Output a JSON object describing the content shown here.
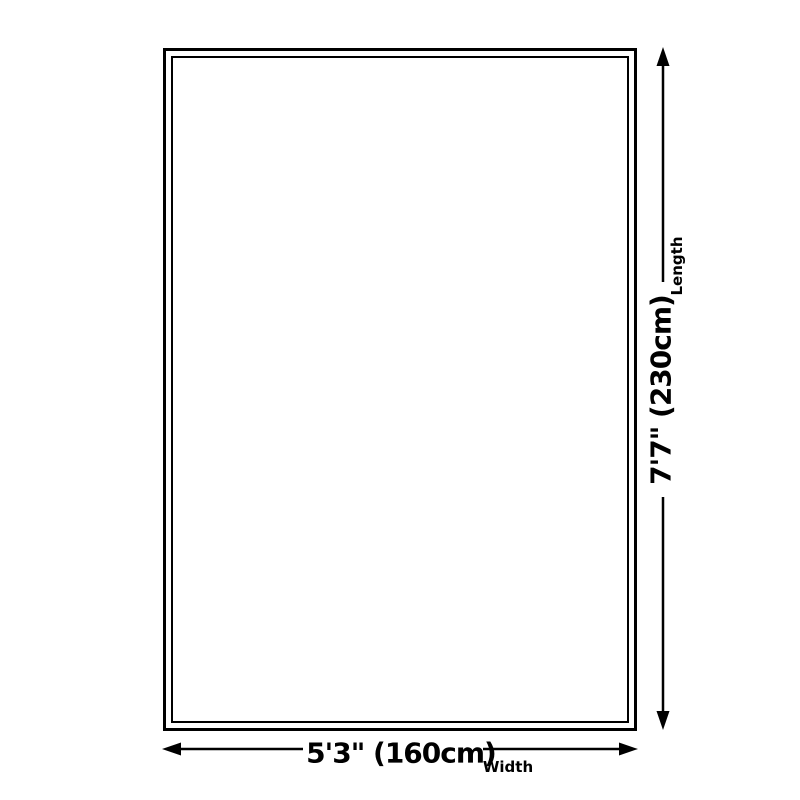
{
  "diagram": {
    "length": {
      "value": "7'7\" (230cm)",
      "label": "Length"
    },
    "width": {
      "value": "5'3\" (160cm)",
      "label": "Width"
    }
  },
  "colors": {
    "line": "#000000",
    "background": "#ffffff"
  }
}
